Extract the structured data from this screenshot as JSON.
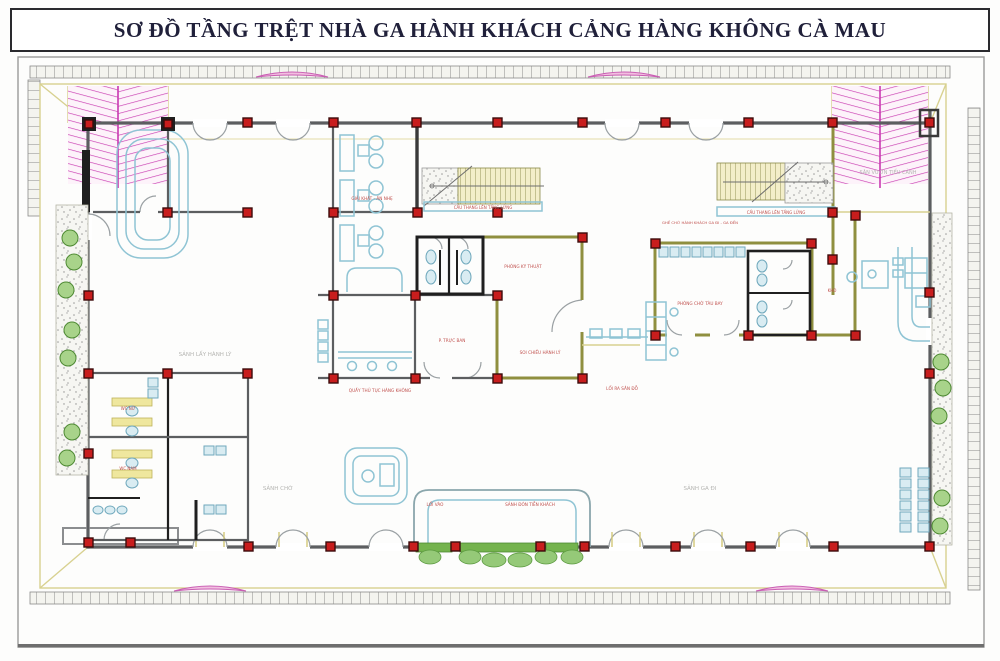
{
  "title": "SƠ ĐỒ TẦNG TRỆT NHÀ GA HÀNH KHÁCH CẢNG HÀNG KHÔNG CÀ MAU",
  "palette": {
    "wall_gray": "#5c5e60",
    "wall_olive": "#8f8f3f",
    "wall_black": "#1f1f1f",
    "column_red": "#c81d1d",
    "furniture_cyan": "#8fc4d4",
    "plants_green": "#74b34d",
    "canopy_magenta": "#c93ab1",
    "arch_pink": "#f2bfe0",
    "stair_tread": "#f3eec9",
    "apron_khaki": "#d8d190",
    "label_red": "#c0504d",
    "label_gray": "#b5b5b2"
  },
  "labels": [
    {
      "text": "SẢNH LẤY HÀNH LÝ",
      "role": "room-label"
    },
    {
      "text": "GIẢI KHÁT - ĂN NHẸ",
      "role": "room-label"
    },
    {
      "text": "CẦU THANG LÊN TẦNG LỬNG",
      "role": "stair-label"
    },
    {
      "text": "PHÒNG KỸ THUẬT",
      "role": "room-label"
    },
    {
      "text": "P. TRỰC BAN",
      "role": "room-label"
    },
    {
      "text": "QUẦY THỦ TỤC HÀNG KHÔNG",
      "role": "room-label"
    },
    {
      "text": "SOI CHIẾU HÀNH LÝ",
      "role": "room-label"
    },
    {
      "text": "LỐI RA SÂN ĐỖ",
      "role": "room-label"
    },
    {
      "text": "GHẾ CHỜ HÀNH KHÁCH GA ĐI - GA ĐẾN",
      "role": "room-label"
    },
    {
      "text": "PHÒNG CHỜ TÀU BAY",
      "role": "room-label"
    },
    {
      "text": "CẦU THANG LÊN TẦNG LỬNG",
      "role": "stair-label"
    },
    {
      "text": "SÂN VƯỜN TIỂU CẢNH",
      "role": "area-label"
    },
    {
      "text": "SẢNH CHỜ",
      "role": "hall-label"
    },
    {
      "text": "SẢNH GA ĐI",
      "role": "hall-label"
    },
    {
      "text": "LỐI VÀO",
      "role": "entrance-label"
    },
    {
      "text": "SẢNH ĐÓN TIỄN KHÁCH",
      "role": "entrance-label"
    },
    {
      "text": "WC NỮ",
      "role": "room-label"
    },
    {
      "text": "WC NAM",
      "role": "room-label"
    },
    {
      "text": "KHO",
      "role": "room-label"
    }
  ]
}
